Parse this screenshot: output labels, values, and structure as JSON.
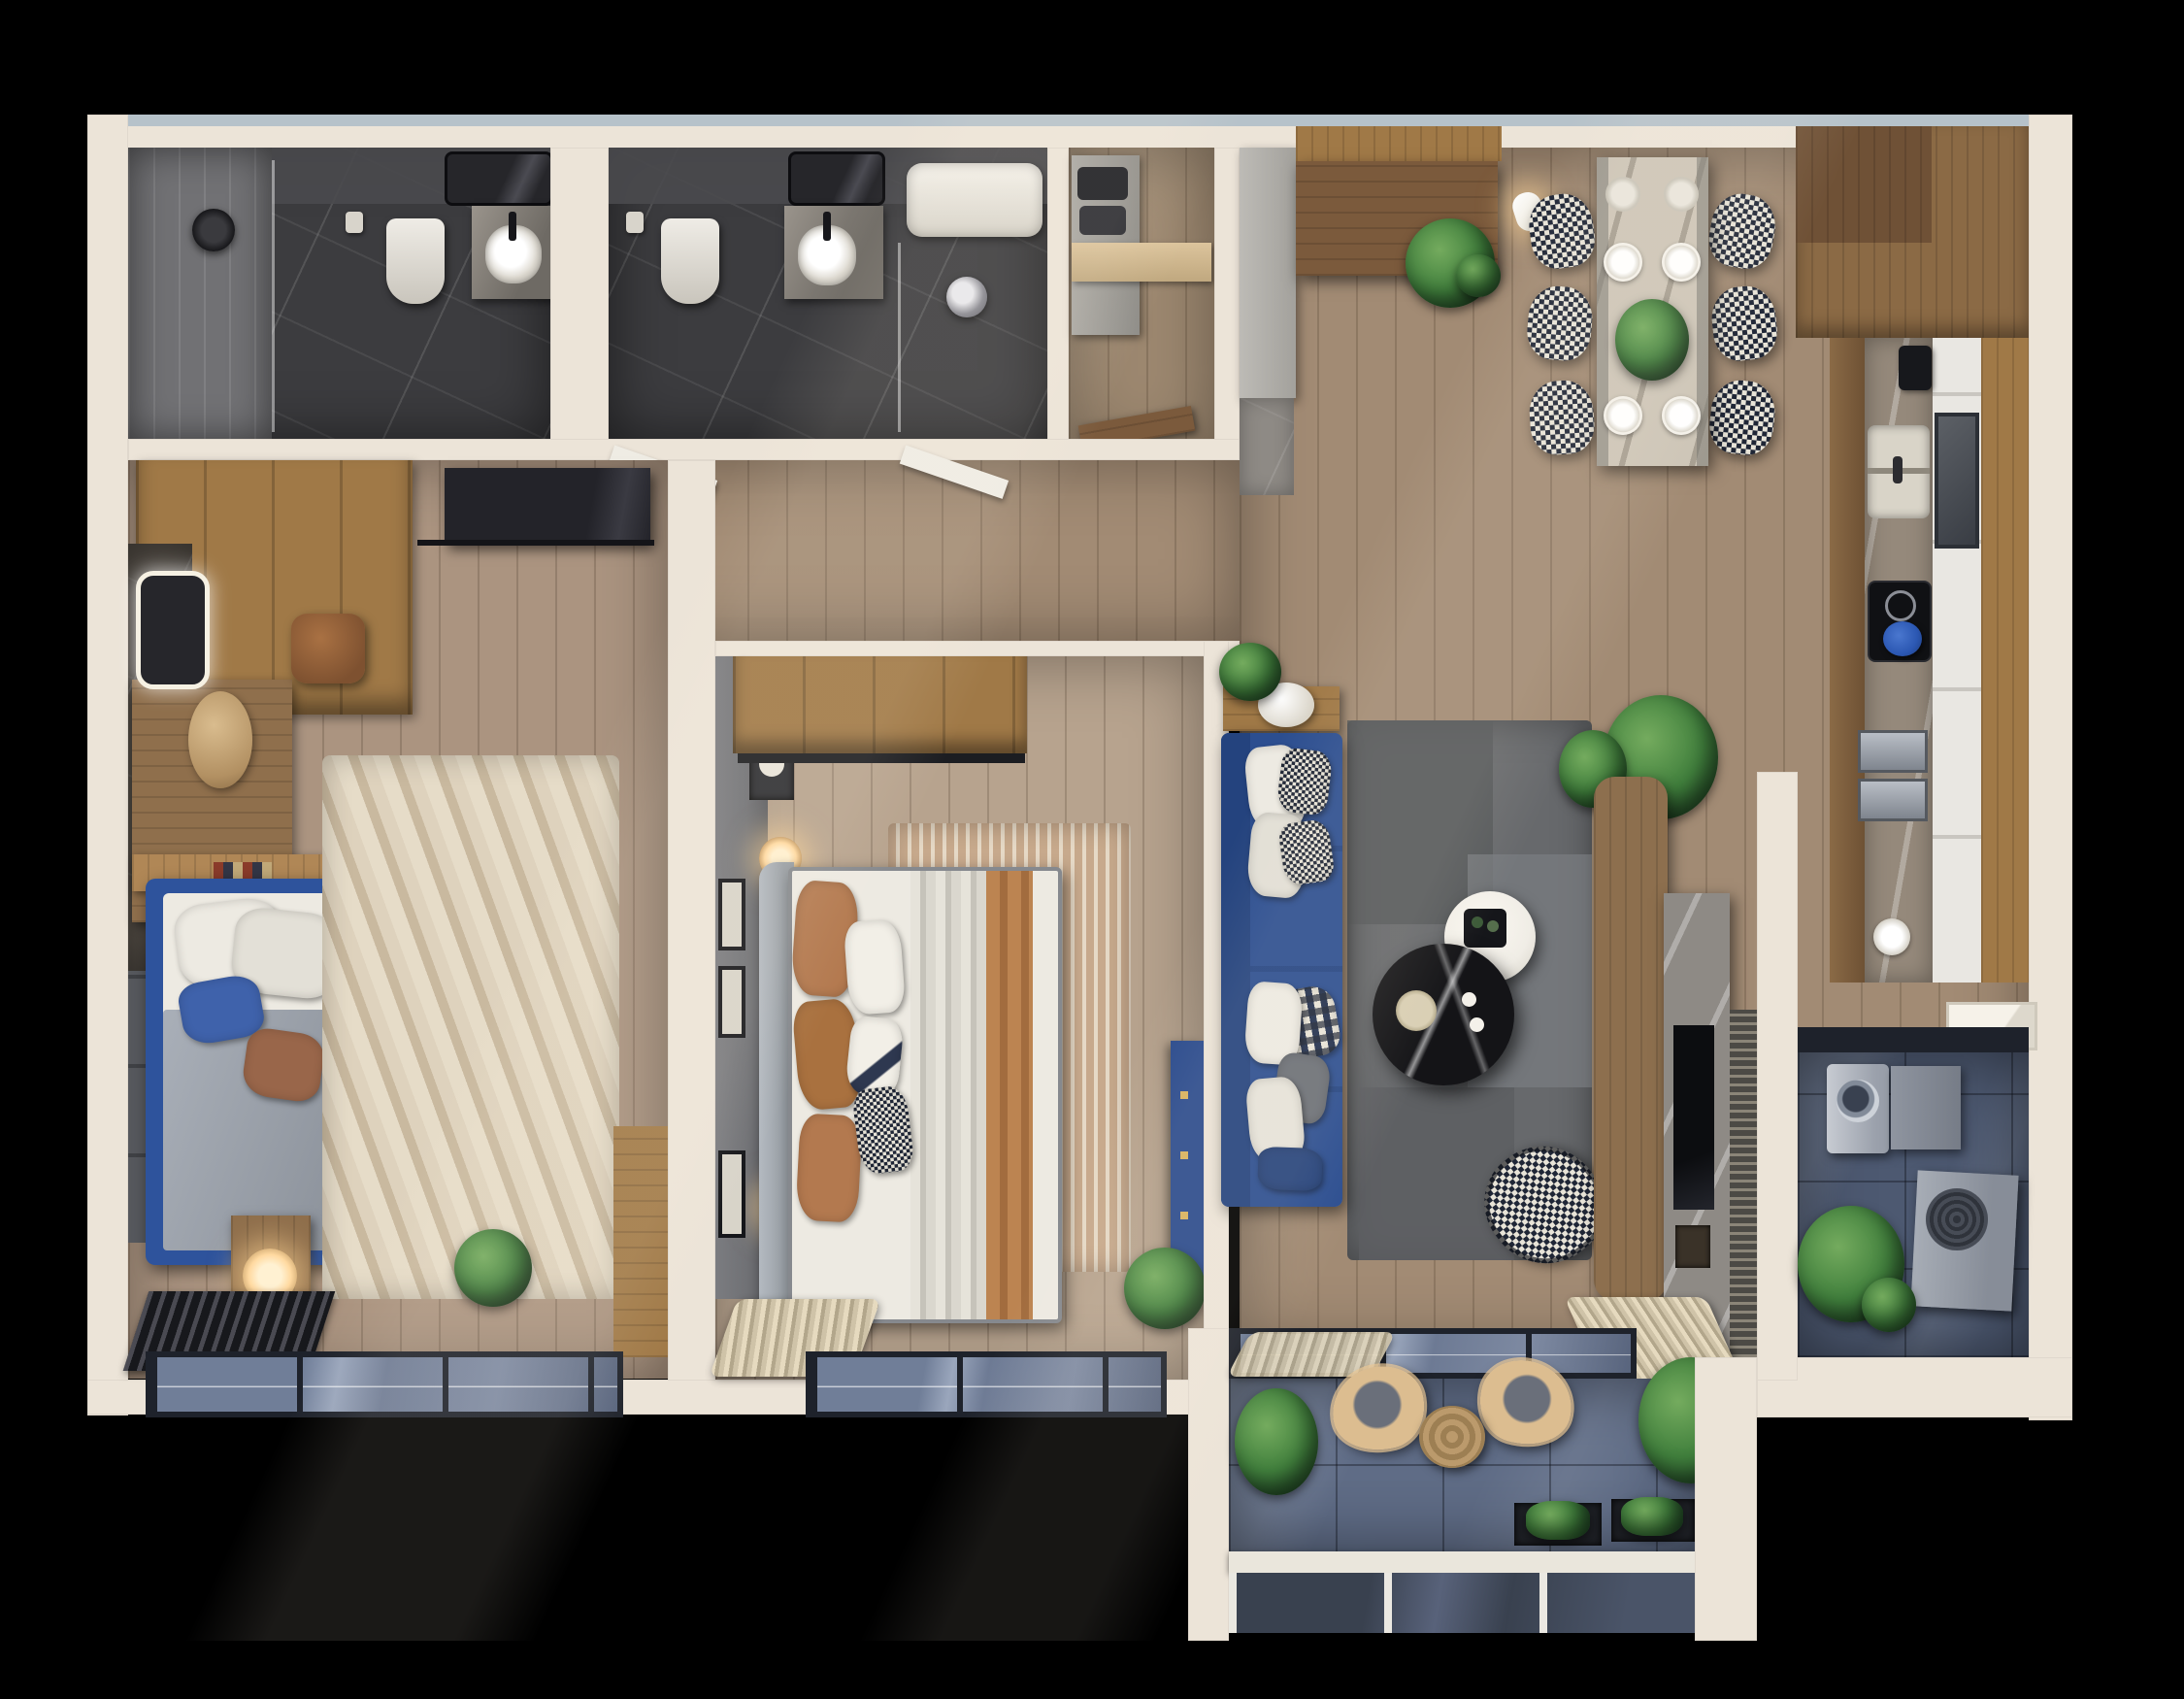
{
  "scene": {
    "type": "apartment-floor-plan-3d-top-view",
    "style": "photorealistic architectural render, no visible text",
    "background_color": "#000000"
  },
  "palette": {
    "wallCream": "#ece4d8",
    "wallTopLight": "#b6c2ca",
    "floorHall": "#a28b74",
    "floorBedL": "#ab9480",
    "floorBed2": "#b7a38e",
    "floorCloset": "#9d8870",
    "bathFloor": "#3c3c3f",
    "showerTile": "#717174",
    "bathWallFace": "#4a4a4e",
    "wood": "#a07947",
    "woodMid": "#8b6a45",
    "woodDark": "#6f5136",
    "doorWood": "#7b5a3c",
    "deskWood": "#8f6f4c",
    "grayCabinet": "#b4b2ad",
    "grayWall": "#707175",
    "upholPanel": "#56585d",
    "headboardGray": "#9aa0a6",
    "sofaBlue": "#2c4e90",
    "sofaBlueDark": "#24437e",
    "bedBlue": "#2e539c",
    "blanketBlue": "#3f62ab",
    "dresserBlue": "#2b4b8d",
    "potBlue": "#2b57b2",
    "rugGray": "#67696c",
    "rugGrayLight": "#7b7d81",
    "rugGrayDark": "#545659",
    "rugTan": "#c7a98c",
    "rugSunLight": "#e6dcc8",
    "rugSunDark": "#c9b99f",
    "duvetGray": "#a9afb8",
    "pillowWhite": "#edeae2",
    "pillowTan": "#b3794f",
    "pillowBrown": "#99664a",
    "throwTan": "#bc8451",
    "marbleBlack": "#141417",
    "tableWhite": "#f0ede6",
    "tableMarble": "#cdc5b7",
    "counterMarble": "#95897b",
    "tileWhite": "#e9e7e2",
    "balconyFloor": "#5f6c86",
    "utilityFloor": "#4d5971",
    "glassBlue": "#76839d",
    "frameDark": "#1e222b",
    "plantGreen": "#41803d",
    "plantDeep": "#2a5a2e",
    "curtainBeige": "#d8cbb2",
    "radiatorDark": "#232327",
    "lampGlow": "#ffd9a0",
    "railWhite": "#eae6dc",
    "applianceGray": "#9aa1ac",
    "washerFace": "#c7cbd2",
    "acGray": "#a7adb6",
    "entryMarble": "#8e8a85"
  },
  "rooms": {
    "bathroom_primary": {
      "label": "bathroom-1",
      "items": [
        "walk-in-shower",
        "rain-shower-head",
        "wall-hung-toilet",
        "vanity-with-sink",
        "mirror",
        "toilet-paper-holder"
      ]
    },
    "bathroom_secondary": {
      "label": "bathroom-2",
      "items": [
        "bathtub",
        "shower-fixture",
        "wall-hung-toilet",
        "vanity-with-sink",
        "mirror",
        "glass-partition"
      ]
    },
    "storage_closet": {
      "label": "storage-closet",
      "items": [
        "appliance-shelving",
        "open-door"
      ]
    },
    "entry_hall": {
      "label": "entry-hall",
      "items": [
        "entrance-door",
        "tall-gray-cabinet",
        "marble-entry-mat",
        "monstera-plant"
      ]
    },
    "dining_area": {
      "label": "dining-area",
      "items": [
        "marble-dining-table",
        "houndstooth-chair-x6",
        "place-setting-x6",
        "centerpiece-plant",
        "pendant-light-x2"
      ]
    },
    "kitchen": {
      "label": "kitchen",
      "items": [
        "tall-wood-cabinets",
        "marble-counter",
        "double-sink",
        "induction-cooktop",
        "blue-dutch-oven",
        "coffee-machine",
        "built-in-ovens",
        "white-cabinet-fronts"
      ]
    },
    "living_room": {
      "label": "living-room",
      "items": [
        "blue-sectional-sofa",
        "throw-pillows",
        "wood-console",
        "white-drum-stool",
        "patchwork-gray-rug",
        "black-marble-coffee-table",
        "white-side-table",
        "houndstooth-armchair",
        "media-wood-panel",
        "marble-fireplace-tv",
        "slatted-screen",
        "potted-plants"
      ]
    },
    "bedroom_left": {
      "label": "bedroom-1",
      "items": [
        "wardrobe",
        "wall-tv",
        "vanity-desk",
        "led-mirror",
        "leather-pouf",
        "pampas-plant",
        "blue-platform-bed",
        "pillows",
        "houndstooth-runner",
        "nightstand",
        "table-lamp",
        "sunburst-rug",
        "radiator-bench",
        "floor-plant",
        "bay-window"
      ]
    },
    "bedroom_middle": {
      "label": "bedroom-2",
      "items": [
        "wardrobe",
        "gray-accent-wall",
        "wall-sconce-x2",
        "framed-art",
        "upholstered-bed",
        "tan-pillows",
        "striped-tan-rug",
        "blue-dresser",
        "sheer-curtain",
        "floor-plant",
        "bay-window"
      ]
    },
    "utility_room": {
      "label": "utility-room",
      "items": [
        "washing-machine",
        "gray-cabinet",
        "ac-condenser-unit",
        "plant",
        "window-sill"
      ]
    },
    "balcony": {
      "label": "balcony",
      "items": [
        "rattan-lounge-chair-x2",
        "rattan-side-table",
        "planter-boxes",
        "glass-balustrade",
        "potted-plants",
        "sliding-window-track",
        "sheer-curtain"
      ]
    }
  }
}
